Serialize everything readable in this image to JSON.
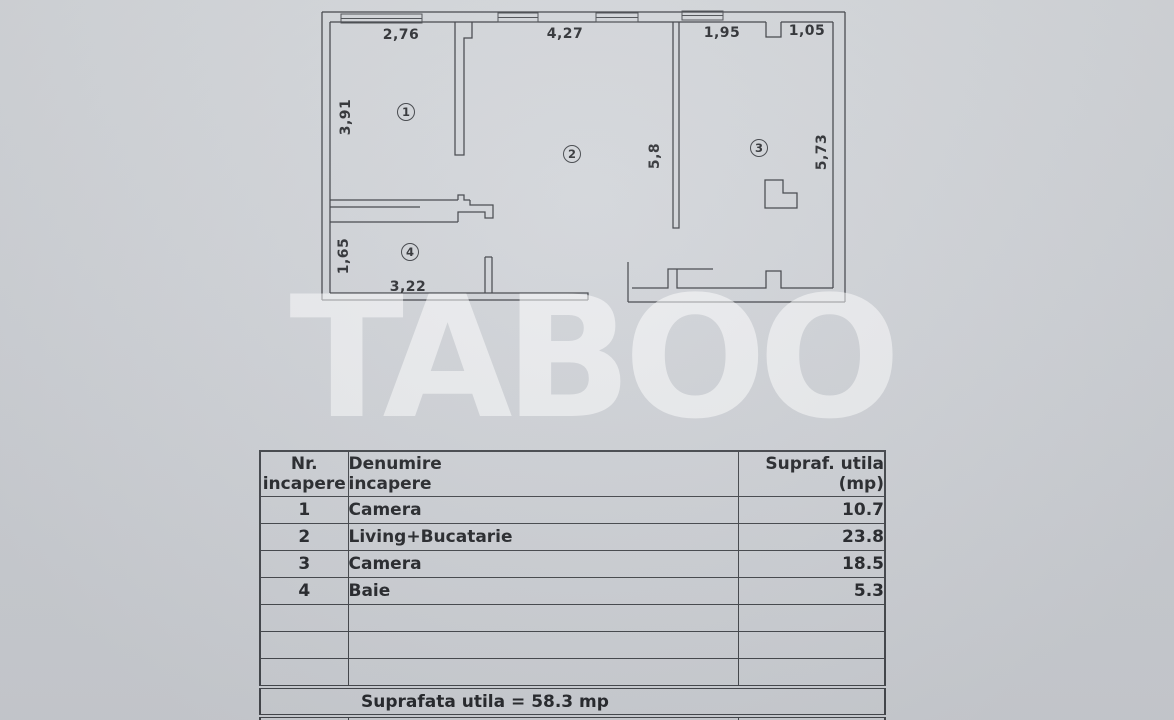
{
  "plan": {
    "dimension_labels": [
      {
        "text": "2,76",
        "x": 401,
        "y": 35,
        "rot": 0
      },
      {
        "text": "4,27",
        "x": 565,
        "y": 34,
        "rot": 0
      },
      {
        "text": "1,95",
        "x": 722,
        "y": 33,
        "rot": 0
      },
      {
        "text": "1,05",
        "x": 807,
        "y": 31,
        "rot": 0
      },
      {
        "text": "3,91",
        "x": 346,
        "y": 117,
        "rot": -90
      },
      {
        "text": "5,8",
        "x": 655,
        "y": 156,
        "rot": -90
      },
      {
        "text": "5,73",
        "x": 822,
        "y": 152,
        "rot": -90
      },
      {
        "text": "1,65",
        "x": 344,
        "y": 256,
        "rot": -90
      },
      {
        "text": "3,22",
        "x": 408,
        "y": 287,
        "rot": 0
      }
    ],
    "room_numbers": [
      {
        "number": "1",
        "x": 406,
        "y": 112
      },
      {
        "number": "2",
        "x": 572,
        "y": 154
      },
      {
        "number": "3",
        "x": 759,
        "y": 148
      },
      {
        "number": "4",
        "x": 410,
        "y": 252
      }
    ]
  },
  "watermark": {
    "text": "TABOO"
  },
  "table": {
    "headers": [
      {
        "line1": "Nr.",
        "line2": "incapere"
      },
      {
        "line1": "Denumire",
        "line2": "incapere"
      },
      {
        "line1": "Supraf. utila",
        "line2": "(mp)"
      }
    ],
    "rows": [
      {
        "nr": "1",
        "name": "Camera",
        "area": "10.7"
      },
      {
        "nr": "2",
        "name": "Living+Bucatarie",
        "area": "23.8"
      },
      {
        "nr": "3",
        "name": "Camera",
        "area": "18.5"
      },
      {
        "nr": "4",
        "name": "Baie",
        "area": "5.3"
      },
      {
        "nr": "",
        "name": "",
        "area": ""
      },
      {
        "nr": "",
        "name": "",
        "area": ""
      },
      {
        "nr": "",
        "name": "",
        "area": ""
      }
    ],
    "total_label": "Suprafata utila = 58.3 mp"
  }
}
